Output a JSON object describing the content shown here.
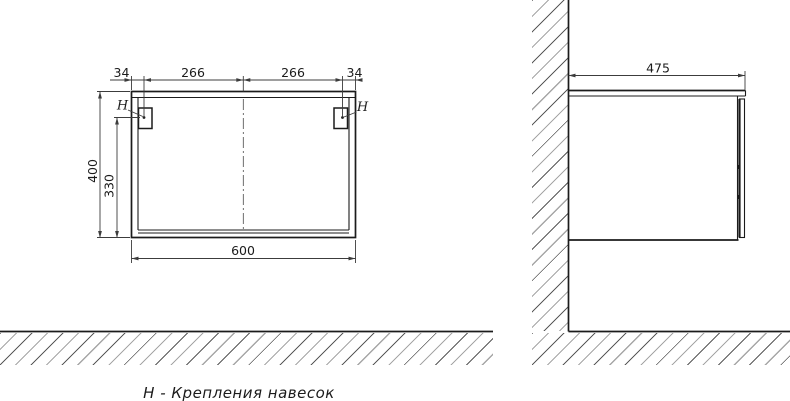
{
  "colors": {
    "line": "#1b1b1b",
    "dim": "#3c3c3c",
    "text": "#1b1b1b",
    "hatch_light": "#a6a6a6",
    "hatch_dark": "#5a5a5a",
    "bg": "#ffffff"
  },
  "caption": "Н - Крепления навесок",
  "front_view": {
    "title": "cabinet front elevation",
    "dimensions": {
      "top_left_offset": "34",
      "top_left_span": "266",
      "top_right_span": "266",
      "top_right_offset": "34",
      "overall_height": "400",
      "hanger_drop_height": "330",
      "overall_width": "600"
    },
    "hanger_left_label": "Н",
    "hanger_right_label": "Н"
  },
  "side_view": {
    "title": "cabinet side section on wall",
    "dimensions": {
      "overall_depth": "475"
    }
  }
}
